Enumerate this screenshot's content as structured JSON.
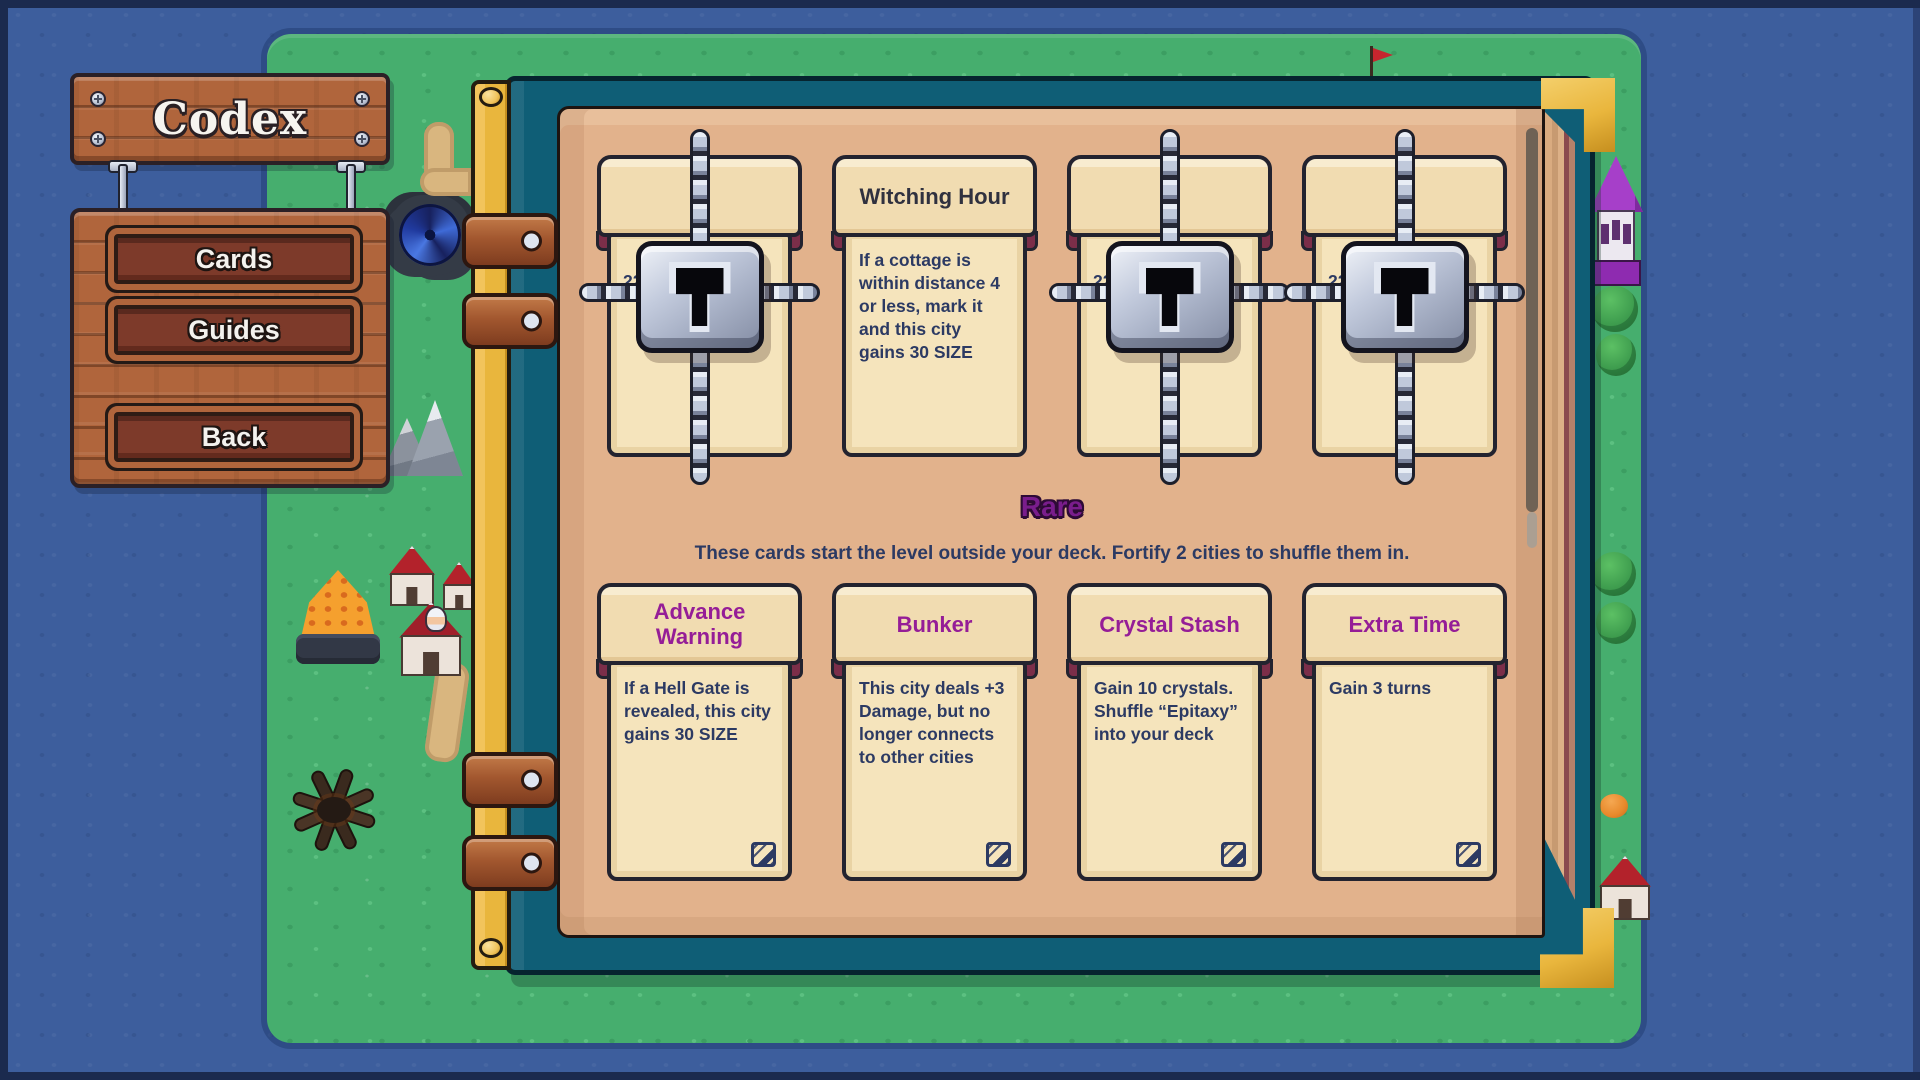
{
  "app": {
    "title": "Codex"
  },
  "menu": {
    "items": [
      {
        "label": "Cards"
      },
      {
        "label": "Guides"
      },
      {
        "label": "Back"
      }
    ]
  },
  "codex": {
    "sections": [
      {
        "heading": "",
        "description": "",
        "cards": [
          {
            "state": "locked",
            "peek_text": "22"
          },
          {
            "state": "revealed",
            "rarity": "common",
            "title": "Witching Hour",
            "text": "If a cottage is within distance 4 or less, mark it and this city gains 30 SIZE"
          },
          {
            "state": "locked",
            "peek_text": "22"
          },
          {
            "state": "locked",
            "peek_text": "22"
          }
        ]
      },
      {
        "heading": "Rare",
        "description": "These cards start the level outside your deck. Fortify 2 cities to shuffle them in.",
        "cards": [
          {
            "state": "revealed",
            "rarity": "rare",
            "title": "Advance Warning",
            "text": "If a Hell Gate is revealed, this city gains 30 SIZE"
          },
          {
            "state": "revealed",
            "rarity": "rare",
            "title": "Bunker",
            "text": "This city deals +3 Damage, but no longer connects to other cities"
          },
          {
            "state": "revealed",
            "rarity": "rare",
            "title": "Crystal Stash",
            "text": "Gain 10 crystals. Shuffle “Epitaxy” into your deck"
          },
          {
            "state": "revealed",
            "rarity": "rare",
            "title": "Extra Time",
            "text": "Gain 3 turns"
          }
        ]
      }
    ]
  },
  "icons": {
    "lock": "padlock-icon",
    "chain": "chain-icon",
    "card_corner": "edit-pen-icon",
    "screw": "screw-icon"
  },
  "colors": {
    "rare_title": "#951d97",
    "rare_heading": "#7a1d8c",
    "common_title": "#30313f",
    "body_text": "#2c3a63",
    "book_cover": "#0f5e76",
    "book_gold": "#e9b63d",
    "page": "#e2b28c",
    "card_cream": "#f5e4bc"
  }
}
